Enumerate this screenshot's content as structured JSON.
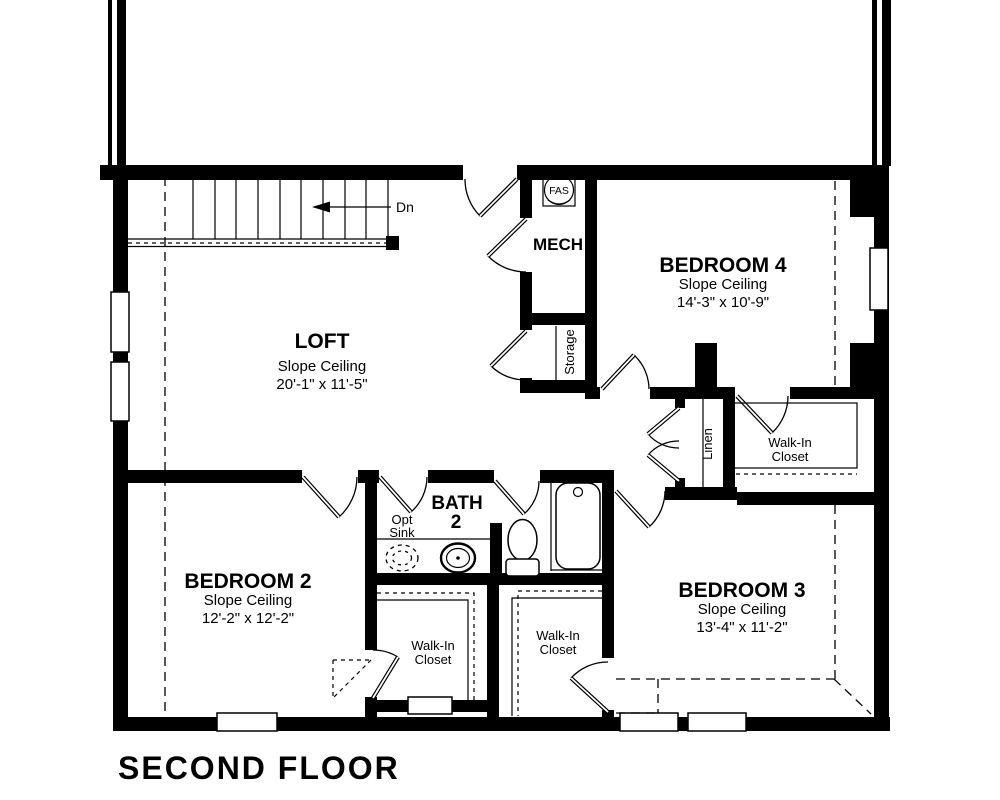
{
  "title": "SECOND FLOOR",
  "stairs": {
    "direction_label": "Dn"
  },
  "equipment": {
    "fan_label": "FAS",
    "mech_label": "MECH",
    "storage_label": "Storage",
    "linen_label": "Linen"
  },
  "rooms": {
    "loft": {
      "name": "LOFT",
      "ceiling": "Slope Ceiling",
      "dims": "20'-1\" x 11'-5\""
    },
    "bedroom2": {
      "name": "BEDROOM 2",
      "ceiling": "Slope Ceiling",
      "dims": "12'-2\" x 12'-2\""
    },
    "bedroom3": {
      "name": "BEDROOM 3",
      "ceiling": "Slope Ceiling",
      "dims": "13'-4\" x 11'-2\""
    },
    "bedroom4": {
      "name": "BEDROOM 4",
      "ceiling": "Slope Ceiling",
      "dims": "14'-3\" x 10'-9\""
    },
    "bath2": {
      "name_line1": "BATH",
      "name_line2": "2",
      "option_line1": "Opt",
      "option_line2": "Sink"
    },
    "closet_bedroom2": {
      "line1": "Walk-In",
      "line2": "Closet"
    },
    "closet_bedroom3": {
      "line1": "Walk-In",
      "line2": "Closet"
    },
    "closet_bedroom4": {
      "line1": "Walk-In",
      "line2": "Closet"
    }
  },
  "colors": {
    "ink": "#000000",
    "background": "#ffffff"
  }
}
